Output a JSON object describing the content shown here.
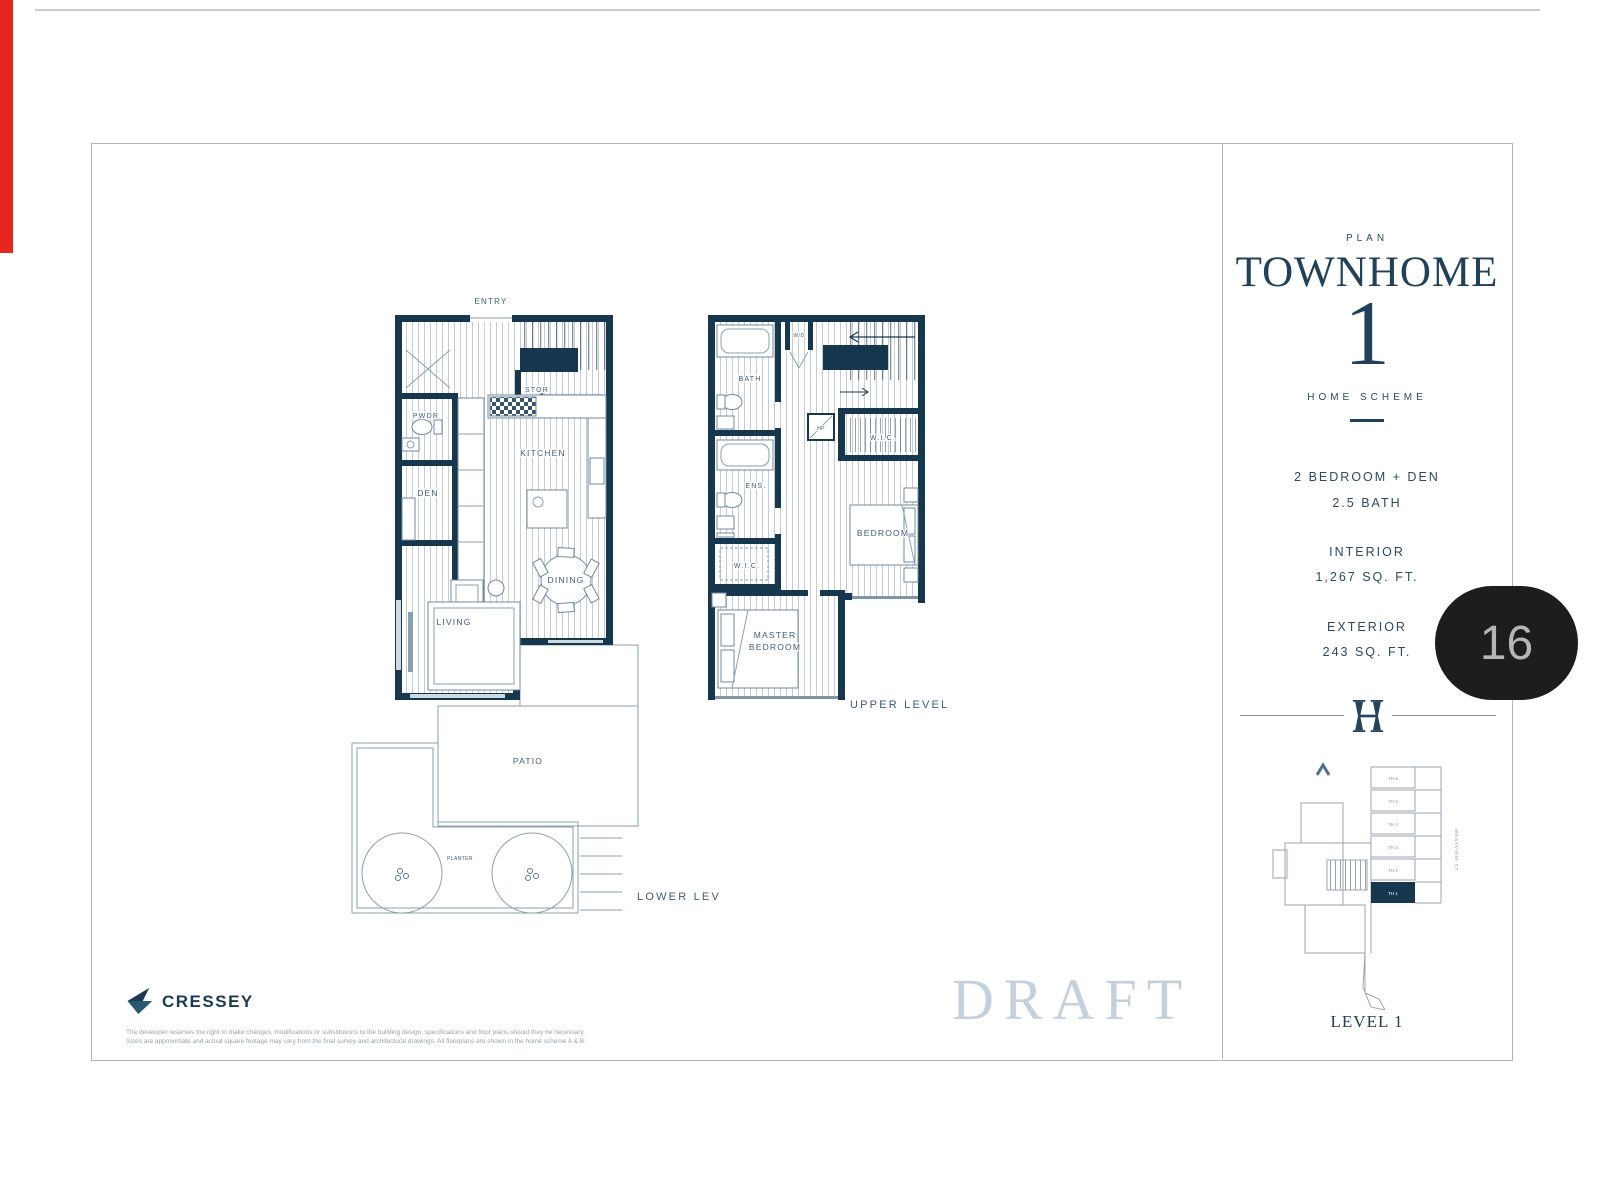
{
  "header_panel": {
    "plan_label": "PLAN",
    "plan_name": "TOWNHOME",
    "plan_number": "1",
    "scheme_label": "HOME SCHEME",
    "bedrooms": "2 BEDROOM + DEN",
    "baths": "2.5 BATH",
    "interior_label": "INTERIOR",
    "interior_area": "1,267 SQ. FT.",
    "exterior_label": "EXTERIOR",
    "exterior_area": "243 SQ. FT."
  },
  "keyplan": {
    "level_label": "LEVEL 1",
    "street_label": "WESTVIEW ST",
    "units": [
      "TH 6",
      "TH 5",
      "TH 4",
      "TH 3",
      "TH 2",
      "TH 1"
    ],
    "highlighted_unit": "TH 1"
  },
  "floorplans": {
    "lower": {
      "title": "LOWER LEVEL",
      "labels": {
        "entry": "ENTRY",
        "stor": "STOR",
        "pwdr": "PWDR",
        "den": "DEN",
        "kitchen": "KITCHEN",
        "dining": "DINING",
        "living": "LIVING",
        "patio": "PATIO",
        "planter": "PLANTER"
      }
    },
    "upper": {
      "title": "UPPER LEVEL",
      "labels": {
        "bath": "BATH",
        "wd": "W/D",
        "ens": "ENS.",
        "wic_left": "W.I.C.",
        "hp": "HP",
        "wic_right": "W.I.C.",
        "bedroom": "BEDROOM",
        "master_line1": "MASTER",
        "master_line2": "BEDROOM"
      }
    }
  },
  "footer": {
    "brand": "CRESSEY",
    "disclaimer_line1": "The developer reserves the right to make changes, modifications or substitutions to the building design, specifications and floor plans should they be necessary.",
    "disclaimer_line2": "Sizes are approximate and actual square footage may vary from the final survey and architectural drawings. All floorplans are shown in the home scheme A & B.",
    "watermark": "DRAFT"
  },
  "overlay": {
    "page_number": "16"
  },
  "colors": {
    "wall_navy": "#16374e",
    "text_navy": "#21405a",
    "draft_watermark": "#c5d0de",
    "badge_background": "#1d1d1f",
    "badge_text": "#b4b5b7",
    "red_bar": "#e8251d"
  }
}
